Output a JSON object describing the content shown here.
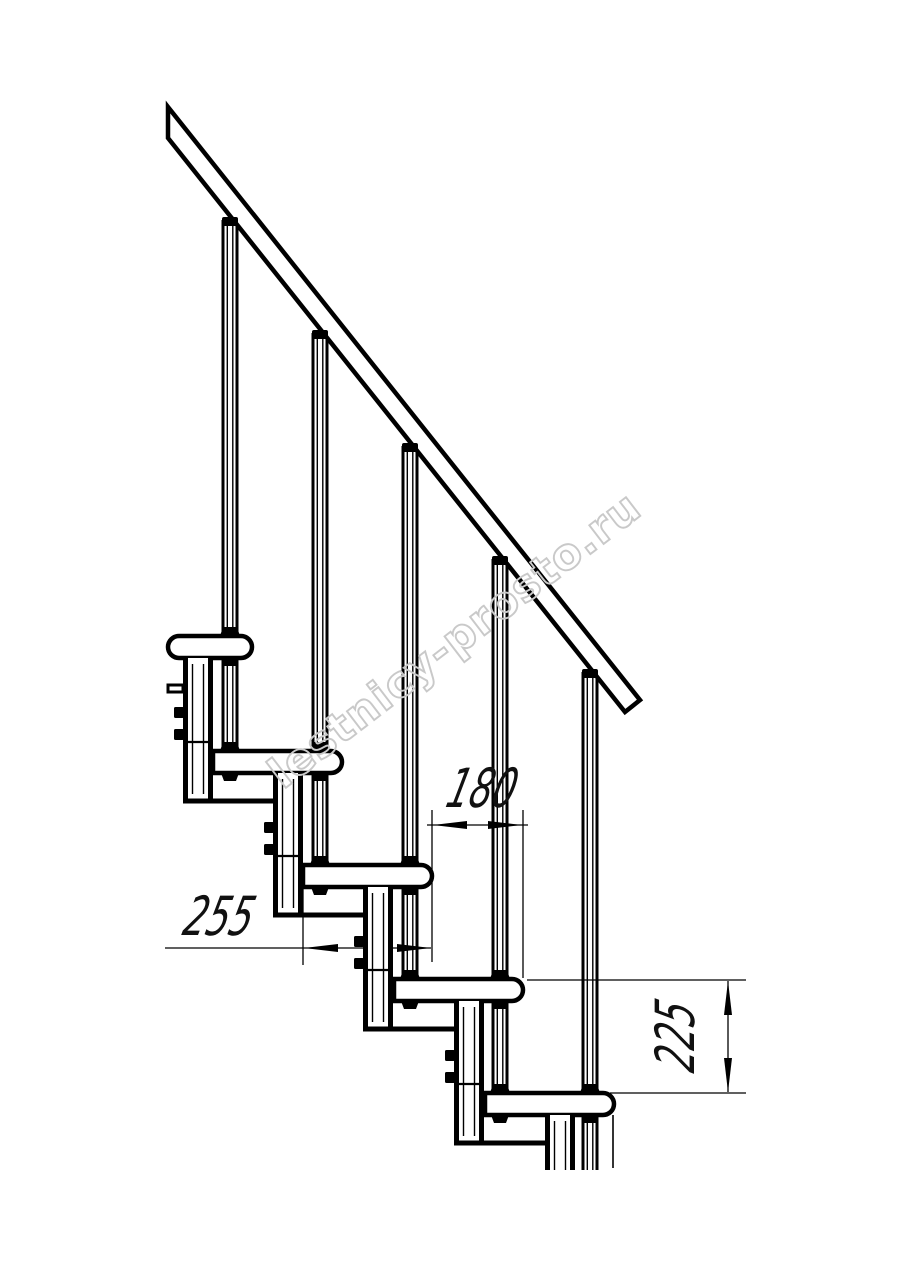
{
  "drawing": {
    "kind": "modular staircase side-view technical drawing",
    "colors": {
      "line": "#000000",
      "background": "#ffffff",
      "dimension_text": "#111111",
      "watermark": "#c9c9c9"
    }
  },
  "dimensions": {
    "going": {
      "value": "180",
      "orientation": "horizontal"
    },
    "depth": {
      "value": "255",
      "orientation": "horizontal"
    },
    "rise": {
      "value": "225",
      "orientation": "vertical"
    }
  },
  "watermark": {
    "text": "lestnicy-prosto.ru"
  }
}
